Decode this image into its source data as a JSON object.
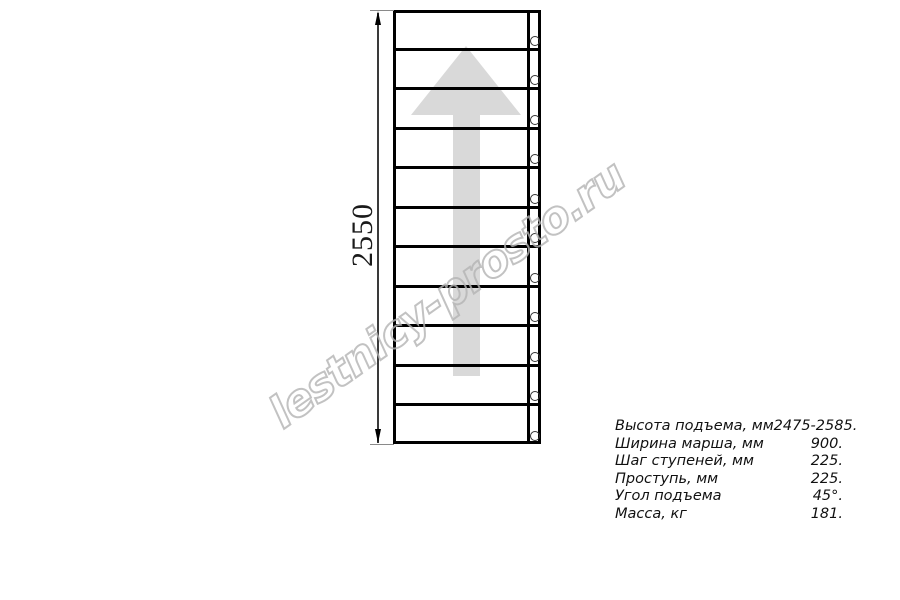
{
  "watermark": {
    "text": "lestnicy-prosto.ru",
    "color": "#b4b4b4"
  },
  "drawing": {
    "type": "staircase-plan-top-view",
    "dimension_label": "2550",
    "tread_count": 11,
    "hole_count": 11,
    "direction_arrow": "up-arrow",
    "line_color": "#000000",
    "arrow_color": "#d9d9d9"
  },
  "specs": {
    "rows": [
      {
        "label": "Высота подъема, мм",
        "value": "2475-2585."
      },
      {
        "label": "Ширина марша, мм",
        "value": "900."
      },
      {
        "label": "Шаг ступеней, мм",
        "value": "225."
      },
      {
        "label": "Проступь, мм",
        "value": "225."
      },
      {
        "label": "Угол подъема",
        "value": "45°."
      },
      {
        "label": "Масса, кг",
        "value": "181."
      }
    ]
  }
}
